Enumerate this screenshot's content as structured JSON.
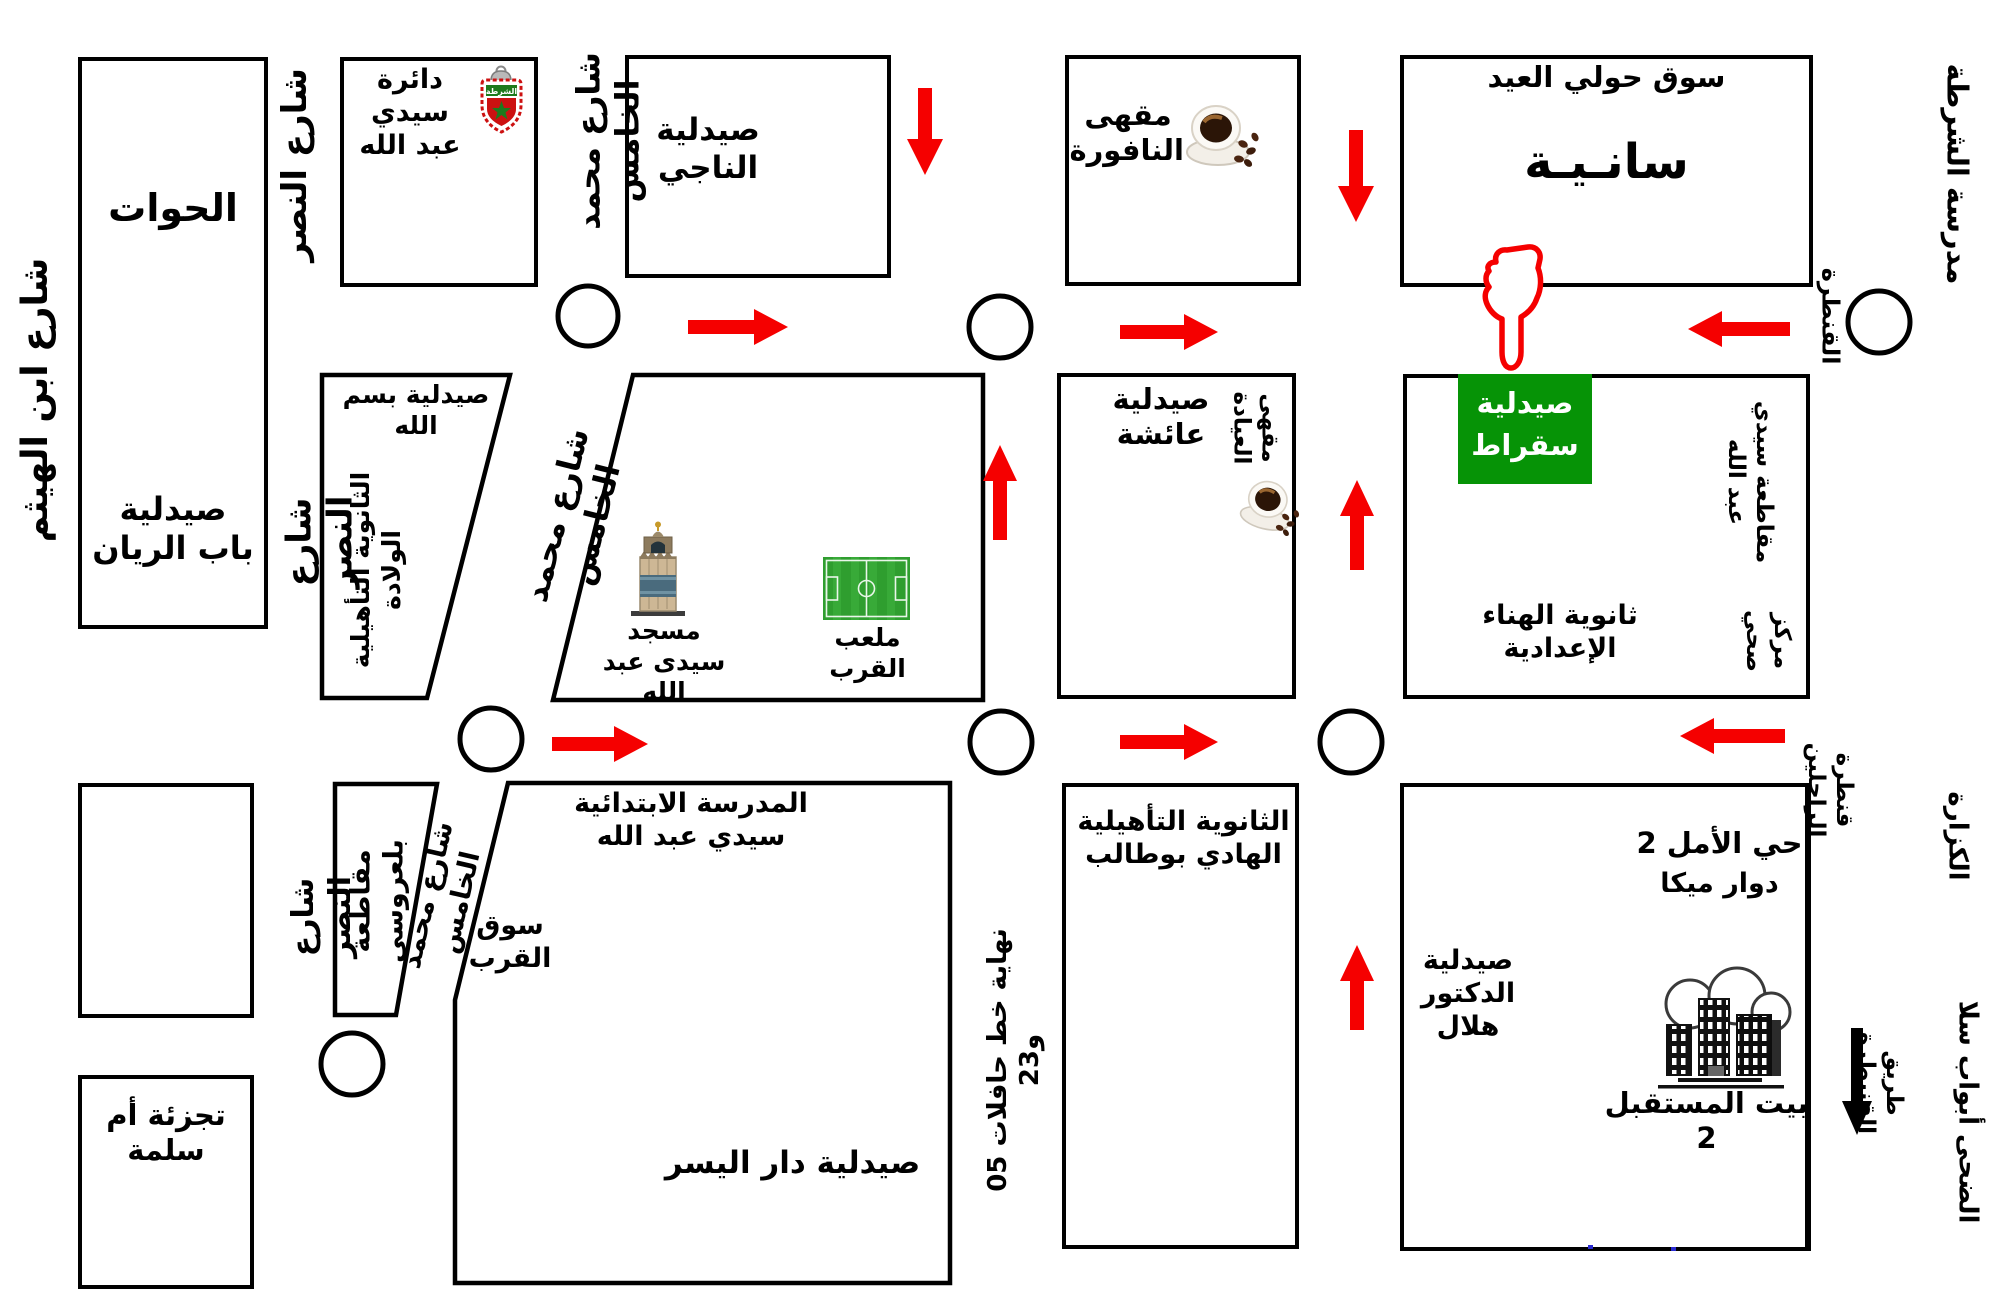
{
  "map_title": "خريطة حي سيدي عبد الله - الوصول إلى صيدلية سقراط",
  "colors": {
    "background": "#ffffff",
    "line_black": "#000000",
    "arrow_red": "#f50000",
    "highlight_green": "#069306",
    "field_green": "#2f9e2f",
    "badge_red": "#cc1111",
    "badge_green": "#1d7a1d"
  },
  "streets": {
    "ibn_haytham": "شارع ابن الهيثم",
    "nasr": "شارع النصر",
    "mohammed_v": "شارع محمد الخامس",
    "police_school": "مدرسة الشرطة",
    "qantara": "القنطرة",
    "rajilin_bridge": "قنطرة الراجلين",
    "kazara": "الكزارة",
    "qunaitra_road": "طريق القنيطرة",
    "duha_abwab_sala": "الضحى أبواب سلا",
    "bus_line_end": "نهاية خط حافلات 05 و23"
  },
  "places": {
    "hawat": "الحوات",
    "bab_rayan_pharmacy": "صيدلية\nباب الريان",
    "sidi_abdellah_district": "دائرة سيدي\nعبد الله",
    "naji_pharmacy": "صيدلية الناجي",
    "nafoura_cafe": "مقهى\nالنافورة",
    "souk_houli_eid": "سوق حولي العيد",
    "saniya": "سانـيـة",
    "bismillah_pharmacy": "صيدلية بسم الله",
    "wilada_school": "الثانوية التأهيلية\nالولادة",
    "mosque": "مسجد\nسيدى عبد الله",
    "qurb_field": "ملعب\nالقرب",
    "aicha_pharmacy": "صيدلية\nعائشة",
    "iyada_cafe": "مقهى\nالعيادة",
    "socrate_pharmacy": "صيدلية\nسقراط",
    "muqataa_sidi_abdellah": "مقاطعة سيدي\nعبد الله",
    "hanaa_school": "ثانوية الهناء\nالإعدادية",
    "health_center": "مركز\nصحي",
    "belaroussi_muqataa": "مقاطعة بلعروسي",
    "qurb_souk": "سوق\nالقرب",
    "primary_school": "المدرسة الابتدائية\nسيدي عبد الله",
    "dar_yusr_pharmacy": "صيدلية دار اليسر",
    "hadi_boutaleb_school": "الثانوية التأهيلية\nالهادي بوطالب",
    "um_salama": "تجزئة أم\nسلمة",
    "amal2": "حي الأمل 2",
    "douar_mika": "دوار ميكا",
    "hilal_pharmacy": "صيدلية\nالدكتور هلال",
    "bait_mustaqbal": "بيت المستقبل 2"
  },
  "icons": {
    "badge": "police-badge-icon",
    "coffee": "coffee-cup-icon",
    "mosque": "mosque-minaret-icon",
    "field": "football-field-icon",
    "buildings": "buildings-icon",
    "hand": "hand-pointer-down-icon"
  }
}
